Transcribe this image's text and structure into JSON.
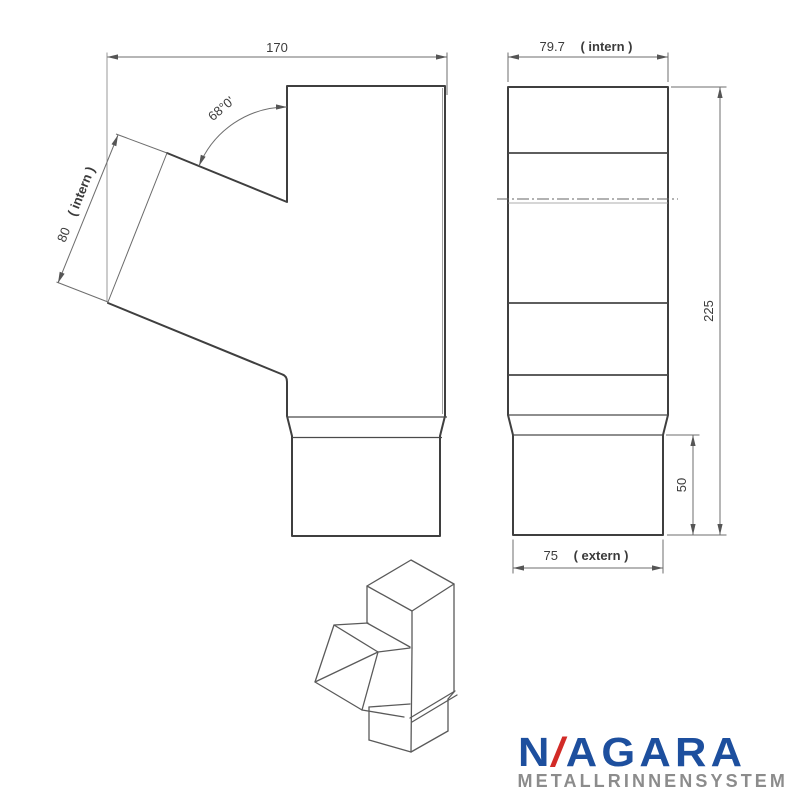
{
  "drawing": {
    "front_view": {
      "dim_total_width": {
        "value": "170"
      },
      "dim_inlet_width": {
        "value": "80",
        "note": "( intern )"
      },
      "dim_angle": {
        "value": "68°0'"
      }
    },
    "side_view": {
      "dim_top_width": {
        "value": "79.7",
        "note": "( intern )"
      },
      "dim_total_height": {
        "value": "225"
      },
      "dim_spout_height": {
        "value": "50"
      },
      "dim_spout_width": {
        "value": "75",
        "note": "( extern )"
      }
    }
  },
  "logo": {
    "brand_prefix": "N",
    "brand_slash": "/",
    "brand_suffix": "AGARA",
    "subtitle": "METALLRINNENSYSTEM",
    "colors": {
      "blue": "#1d4f9e",
      "red": "#d22b27",
      "gray": "#8c8c8c"
    }
  },
  "colors": {
    "outline": "#3f3f3f",
    "dimension_lines": "#6e6e6e",
    "text": "#3b3b3b",
    "background": "#ffffff"
  }
}
